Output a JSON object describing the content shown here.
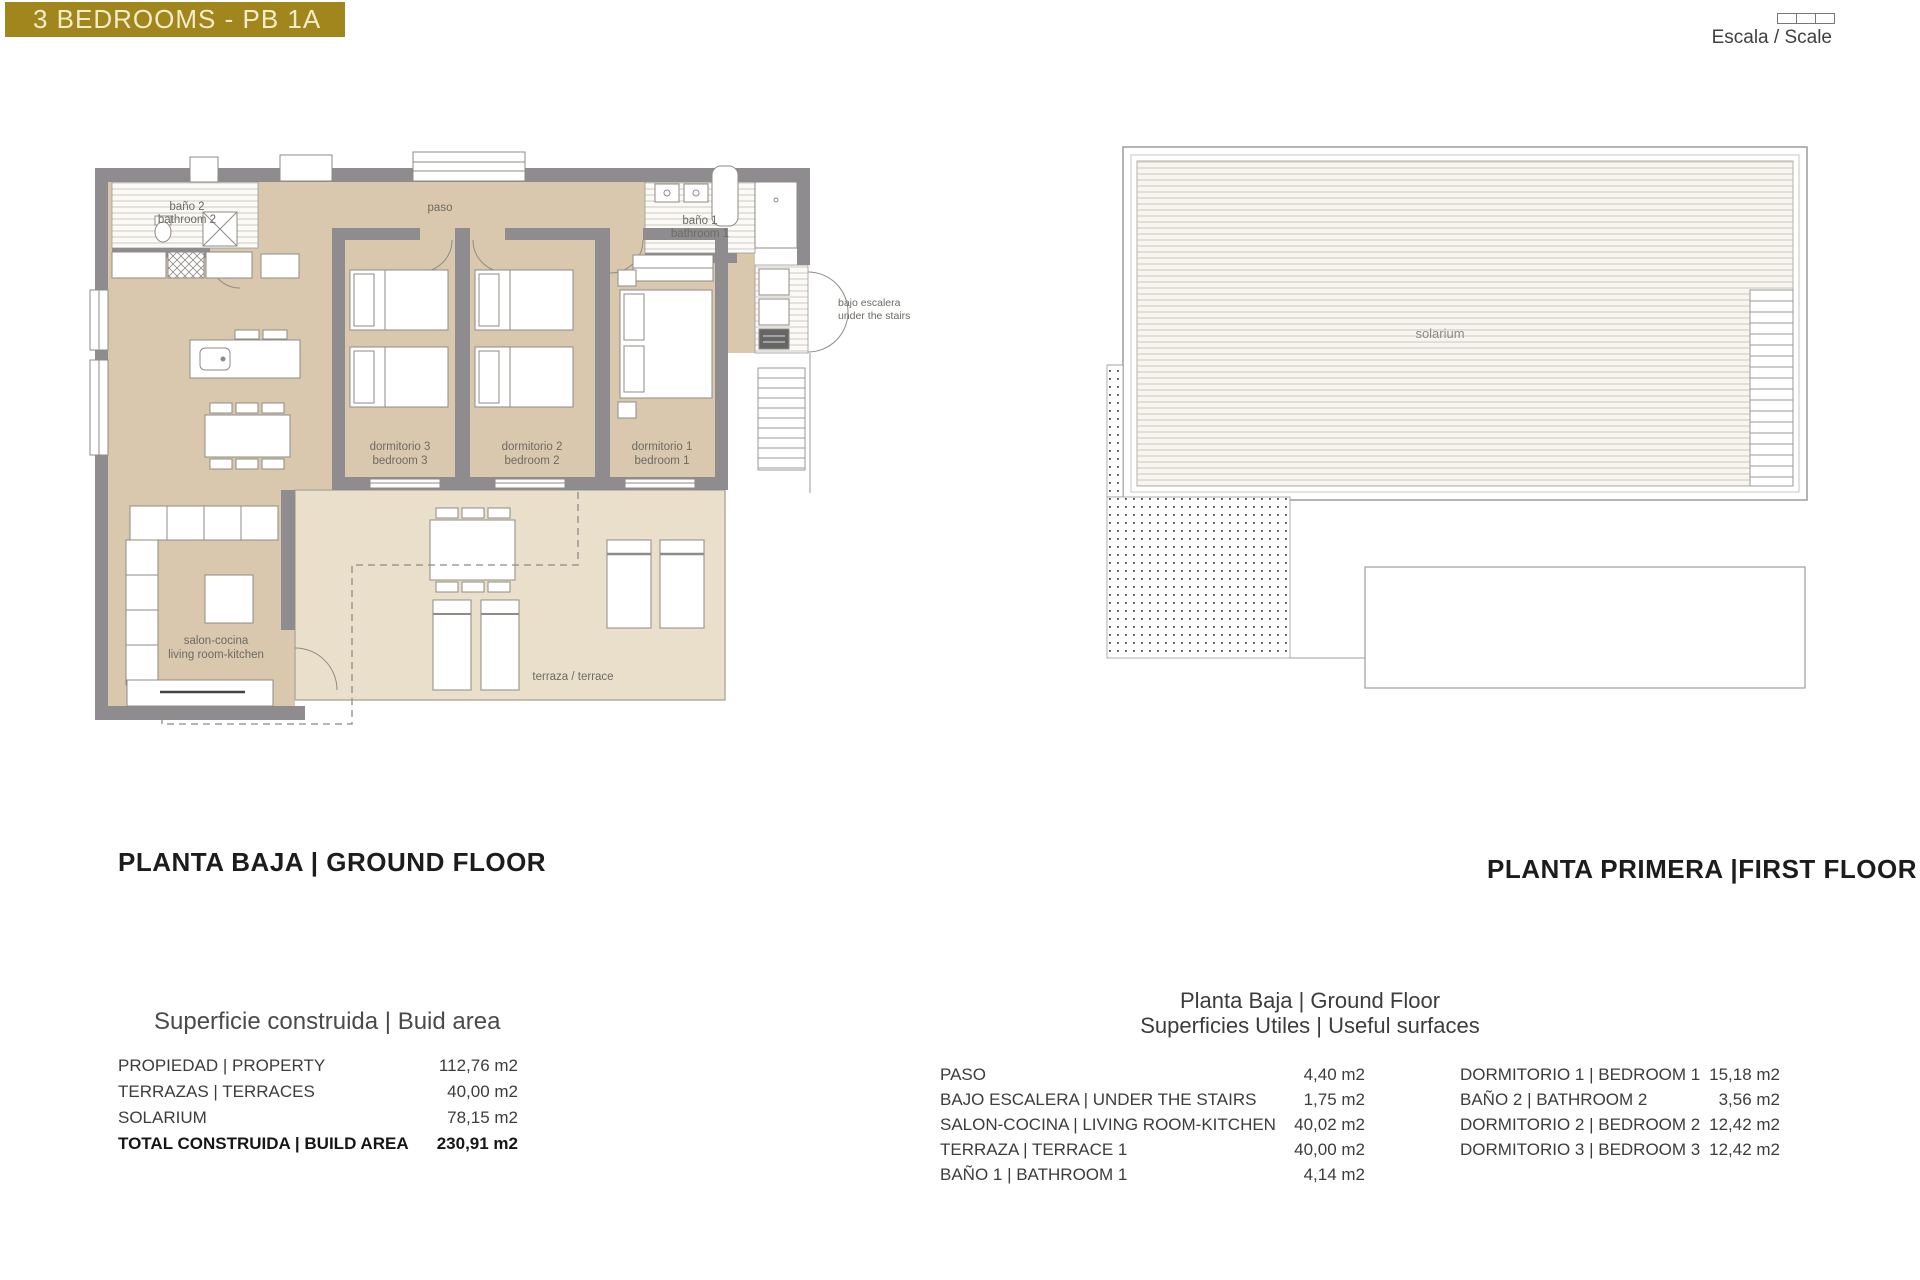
{
  "banner": {
    "text": "3 BEDROOMS - PB 1A",
    "bg": "#A1861E",
    "fg": "#F3ECC8"
  },
  "scale_widget": {
    "label": "Escala / Scale"
  },
  "ground_floor": {
    "caption": "PLANTA BAJA | GROUND FLOOR",
    "labels": {
      "bano2_l1": "baño 2",
      "bano2_l2": "bathroom 2",
      "paso": "paso",
      "bano1_l1": "baño 1",
      "bano1_l2": "bathroom 1",
      "bajo_l1": "bajo escalera",
      "bajo_l2": "under the stairs",
      "dorm3_l1": "dormitorio 3",
      "dorm3_l2": "bedroom 3",
      "dorm2_l1": "dormitorio 2",
      "dorm2_l2": "bedroom 2",
      "dorm1_l1": "dormitorio 1",
      "dorm1_l2": "bedroom 1",
      "salon_l1": "salon-cocina",
      "salon_l2": "living room-kitchen",
      "terraza": "terraza / terrace"
    }
  },
  "first_floor": {
    "caption": "PLANTA PRIMERA |FIRST FLOOR",
    "labels": {
      "solarium": "solarium"
    }
  },
  "build_area_table": {
    "title": "Superficie construida | Buid area",
    "rows": [
      {
        "label": "PROPIEDAD | PROPERTY",
        "value": "112,76 m2"
      },
      {
        "label": "TERRAZAS | TERRACES",
        "value": "40,00 m2"
      },
      {
        "label": "SOLARIUM",
        "value": "78,15 m2"
      },
      {
        "label": "TOTAL CONSTRUIDA | BUILD AREA",
        "value": "230,91 m2"
      }
    ]
  },
  "useful_table": {
    "title_l1": "Planta Baja | Ground Floor",
    "title_l2": "Superficies Utiles | Useful surfaces",
    "left_rows": [
      {
        "label": "PASO",
        "value": "4,40 m2"
      },
      {
        "label": "BAJO ESCALERA | UNDER THE STAIRS",
        "value": "1,75 m2"
      },
      {
        "label": "SALON-COCINA | LIVING ROOM-KITCHEN",
        "value": "40,02 m2"
      },
      {
        "label": "TERRAZA | TERRACE 1",
        "value": "40,00 m2"
      },
      {
        "label": "BAÑO 1 | BATHROOM 1",
        "value": "4,14 m2"
      }
    ],
    "right_rows": [
      {
        "label": "DORMITORIO 1 | BEDROOM 1",
        "value": "15,18 m2"
      },
      {
        "label": "BAÑO 2 | BATHROOM 2",
        "value": "3,56 m2"
      },
      {
        "label": "DORMITORIO 2 | BEDROOM 2",
        "value": "12,42 m2"
      },
      {
        "label": "DORMITORIO 3 | BEDROOM 3",
        "value": "12,42 m2"
      }
    ]
  },
  "colors": {
    "banner_bg": "#A1861E",
    "banner_fg": "#F3ECC8",
    "wall": "#8E8C8E",
    "floor": "#D9C8AE",
    "terrace": "#E9DFCA",
    "caption_text": "#1C1C1C",
    "table_text": "#3C3C3C",
    "plan_label": "#6E6A64"
  }
}
